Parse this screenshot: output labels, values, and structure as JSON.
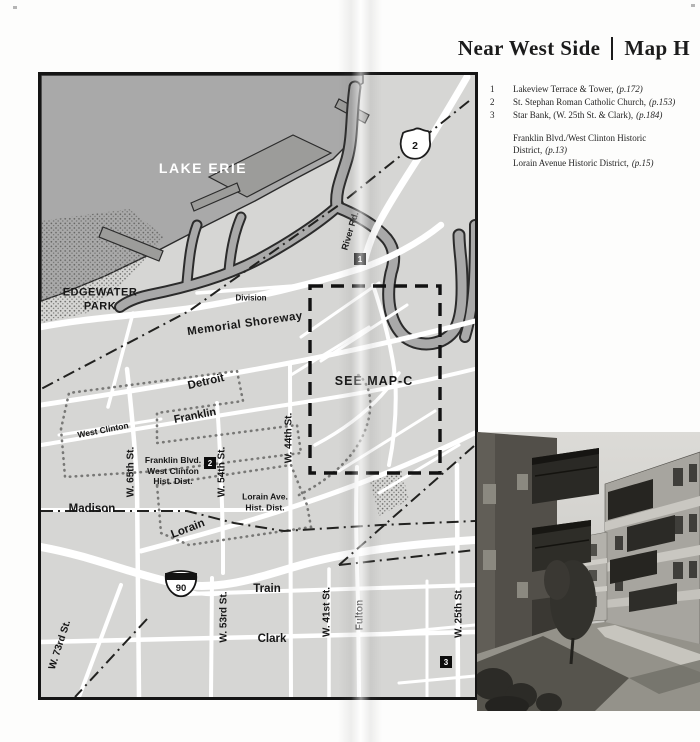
{
  "title": {
    "section": "Near West Side",
    "map_id": "Map H"
  },
  "legend": {
    "items": [
      {
        "num": "1",
        "name": "Lakeview Terrace & Tower,",
        "ref": "(p.172)"
      },
      {
        "num": "2",
        "name": "St. Stephan Roman Catholic Church,",
        "ref": "(p.153)"
      },
      {
        "num": "3",
        "name": "Star Bank, (W. 25th St. & Clark),",
        "ref": "(p.184)"
      }
    ],
    "districts": [
      {
        "name": "Franklin Blvd./West Clinton Historic District,",
        "ref": "(p.13)"
      },
      {
        "name": "Lorain Avenue Historic District,",
        "ref": "(p.15)"
      }
    ]
  },
  "map": {
    "water_label": "LAKE ERIE",
    "park": {
      "l1": "EDGEWATER",
      "l2": "PARK"
    },
    "see_map": "SEE MAP-C",
    "streets": {
      "division": "Division",
      "memorial": "Memorial Shoreway",
      "detroit": "Detroit",
      "franklin": "Franklin",
      "west_clinton": "West Clinton",
      "madison": "Madison",
      "lorain": "Lorain",
      "train": "Train",
      "clark": "Clark",
      "river_rd": "River Rd.",
      "w73": "W. 73rd St.",
      "w65": "W. 65th St.",
      "w54": "W. 54th St.",
      "w53": "W. 53rd St.",
      "w44": "W. 44th St.",
      "w41": "W. 41st St.",
      "fulton": "Fulton",
      "w25": "W. 25th St"
    },
    "districts": {
      "franklin_hd": {
        "l1": "Franklin Blvd.",
        "l2": "West Clinton",
        "l3": "Hist. Dist."
      },
      "lorain_hd": {
        "l1": "Lorain Ave.",
        "l2": "Hist. Dist."
      }
    },
    "markers": {
      "site1": "1",
      "site2": "2",
      "site3": "3",
      "route_shield": "2",
      "interstate_shield": "90"
    }
  },
  "colors": {
    "land": "#d6d6d4",
    "water": "#a9a9a9",
    "road": "#ffffff",
    "ink": "#161616"
  }
}
